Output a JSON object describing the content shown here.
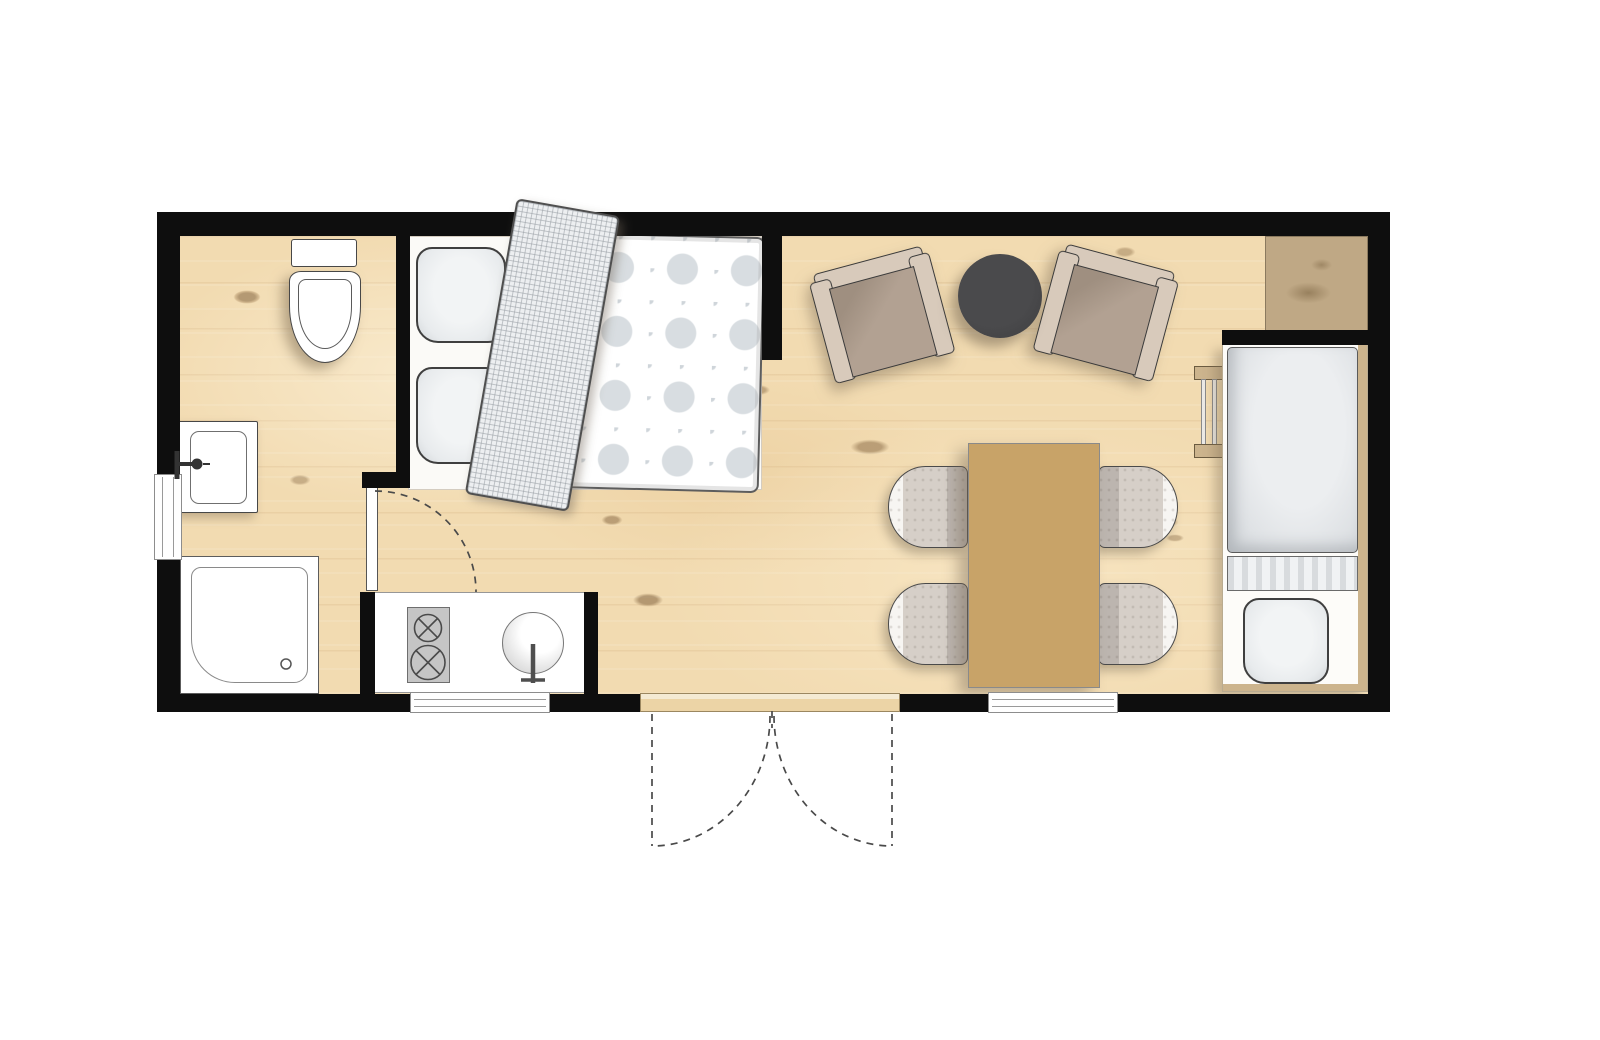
{
  "meta": {
    "aria_label": "Floor plan of a small holiday lodge"
  },
  "colors": {
    "wall": "#0e0e0e",
    "floor": "#f2dbb1",
    "threshold": "#ecd4a6",
    "bedding": "#e8ebed",
    "duvet-dot": "#d8dde1",
    "armchair-frame": "#d8cabb",
    "armchair-seat": "#b2a192",
    "side-table": "#3e3e40",
    "dining-table": "#c8a368",
    "chair-seat": "#d6cfc8",
    "chair-back": "#f7f5f2",
    "chair-shade": "#bcb5af",
    "cabinet": "#bfa885",
    "bed-trim": "#ccb48d",
    "stove": "#c5c5c5"
  },
  "plan": {
    "rooms": [
      {
        "name": "bathroom",
        "fixtures": [
          "toilet",
          "washbasin",
          "shower",
          "hinged-door"
        ]
      },
      {
        "name": "sleeping-area",
        "furniture": [
          "double-bed",
          "pillow",
          "pillow",
          "folded-blanket",
          "patterned-duvet"
        ]
      },
      {
        "name": "kitchen",
        "furniture": [
          "counter",
          "two-burner-stove",
          "round-sink"
        ]
      },
      {
        "name": "living-dining",
        "furniture": [
          "armchair",
          "armchair",
          "round-side-table",
          "dining-table",
          "dining-chair",
          "dining-chair",
          "dining-chair",
          "dining-chair",
          "corner-cabinet"
        ]
      },
      {
        "name": "single-bed-nook",
        "furniture": [
          "single-bed",
          "pillow",
          "ladder"
        ]
      }
    ],
    "openings": [
      "left-wall-window",
      "kitchen-window",
      "dining-window",
      "double-entry-doors",
      "bathroom-door"
    ]
  }
}
